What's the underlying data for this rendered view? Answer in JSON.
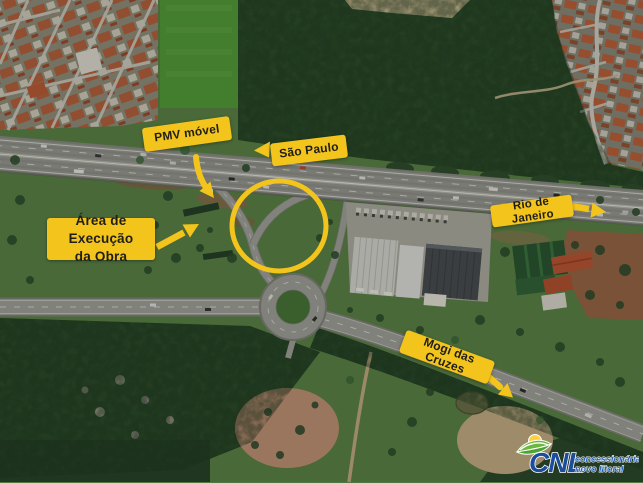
{
  "annotations": {
    "accent_color": "#F2C41C",
    "pmv_label": "PMV móvel",
    "sao_paulo_label": "São Paulo",
    "rio_label": "Rio de Janeiro",
    "mogi_label": "Mogi das Cruzes",
    "area_label_line1": "Área de Execução",
    "area_label_line2": "da Obra"
  },
  "logo": {
    "acronym": "CNL",
    "tagline_line1": "concessionária",
    "tagline_line2": "novo litoral",
    "blue": "#1c4e9d",
    "light_blue": "#2a67b8",
    "green": "#4ea433",
    "yellow": "#ffd23c"
  }
}
